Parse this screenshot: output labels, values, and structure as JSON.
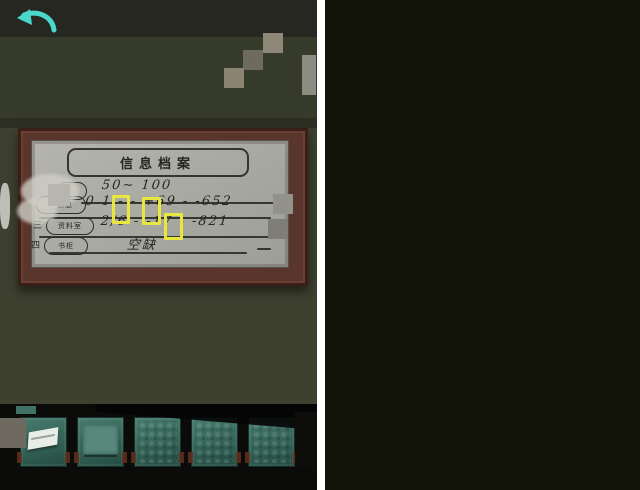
{
  "app": {
    "type": "escape-game-screenshot-pair"
  },
  "colors": {
    "highlight_yellow": "#e9e63f",
    "arrow_teal": "#4ad8cc",
    "slot_teal": "#3f7164",
    "wall_olive": "#3e4130",
    "frame_maroon": "#5a352c",
    "paper_grey": "#aeaea6"
  },
  "left_panel": {
    "back_icon": "curved-back-arrow",
    "note": {
      "title": "信息档案",
      "rows": [
        {
          "num": "",
          "label": "",
          "value": "50~ 100"
        },
        {
          "num": "",
          "label": "户信息",
          "value": "0 1 - -  +69 - -652"
        },
        {
          "num": "三",
          "label": "资料室",
          "value": "2/6 - -17  - -821"
        },
        {
          "num": "四",
          "label": "书柜",
          "value": "空缺"
        }
      ],
      "highlighted_gaps_on_paper": 3
    }
  },
  "right_panel": {
    "back_icon": "curved-back-arrow",
    "shelves": {
      "scroll_books": {
        "count": 14,
        "spine_text": "用户信息",
        "highlighted_books": [
          2,
          5
        ]
      },
      "navy_books": {
        "count": 13,
        "highlighted_books": [
          8
        ]
      },
      "color_books": {
        "items": [
          {
            "c": "#2c3c2a",
            "h": 56
          },
          {
            "c": "#47231f",
            "h": 60
          },
          {
            "c": "#1f2c3e",
            "h": 52
          },
          {
            "c": "#6b2a22",
            "h": 62
          },
          {
            "c": "#3a3f46",
            "h": 50
          },
          {
            "c": "#53301f",
            "h": 64
          },
          {
            "c": "#20354a",
            "h": 55
          },
          {
            "c": "#18222e",
            "h": 60
          },
          {
            "c": "#432b3c",
            "h": 52
          },
          {
            "c": "#35262a",
            "h": 58
          },
          {
            "c": "#1d3a33",
            "h": 49
          },
          {
            "c": "#0f1a24",
            "h": 62
          },
          {
            "c": "#55342a",
            "h": 54
          },
          {
            "c": "#262d44",
            "h": 60
          },
          {
            "c": "#433546",
            "h": 52
          },
          {
            "c": "#243240",
            "h": 57
          }
        ]
      },
      "cabinet": {
        "doors": 2,
        "handles": 2
      }
    }
  },
  "inventory": {
    "slots": [
      {
        "name": "paper-note"
      },
      {
        "name": "teal-card"
      },
      {
        "name": "pattern-book"
      },
      {
        "name": "pattern-book"
      },
      {
        "name": "pattern-book"
      }
    ]
  }
}
